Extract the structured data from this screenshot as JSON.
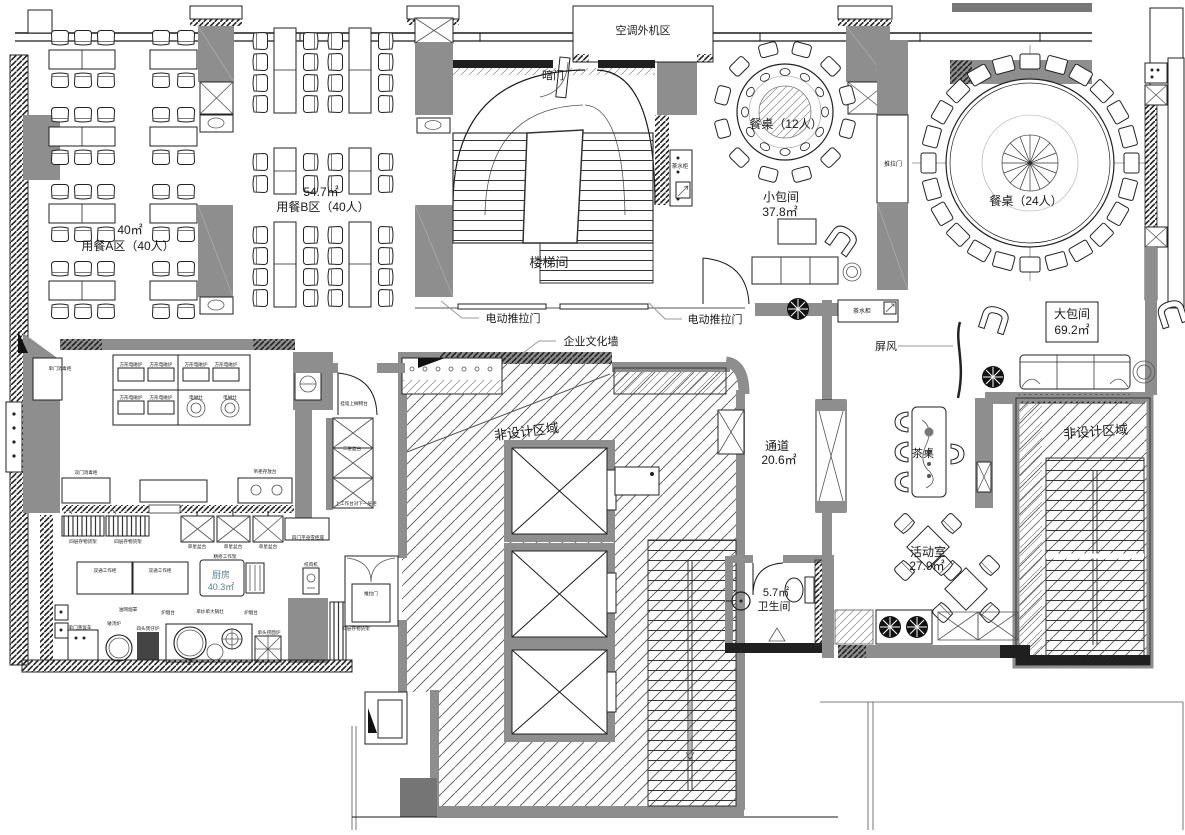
{
  "colors": {
    "wall_gray": "#8e8e8e",
    "dark_band": "#1f1f1f",
    "line": "#1a1a1a",
    "hatch": "#555555",
    "kitchen_text": "#5b7f91"
  },
  "rooms": {
    "ac_unit_area": {
      "name": "空调外机区"
    },
    "stairwell": {
      "name": "楼梯间"
    },
    "dining_a": {
      "name": "用餐A区（40人）",
      "area": "40㎡"
    },
    "dining_b": {
      "name": "用餐B区（40人）",
      "area": "54.7㎡"
    },
    "table_12": {
      "name": "餐桌（12人）"
    },
    "table_24": {
      "name": "餐桌（24人）"
    },
    "small_room": {
      "name": "小包间",
      "area": "37.8㎡"
    },
    "big_room": {
      "name": "大包间",
      "area": "69.2㎡"
    },
    "corridor": {
      "name": "通道",
      "area": "20.6㎡"
    },
    "activity_room": {
      "name": "活动室",
      "area": "27.9㎡"
    },
    "toilet": {
      "name": "卫生间",
      "area": "5.7㎡"
    },
    "kitchen": {
      "name": "厨房",
      "area": "40.3㎡"
    },
    "non_design_center": {
      "name": "非设计区域"
    },
    "non_design_right": {
      "name": "非设计区域"
    }
  },
  "annotations": {
    "hidden_door": "暗门",
    "electric_sliding_door": "电动推拉门",
    "sliding_door": "推拉门",
    "culture_wall": "企业文化墙",
    "screen": "屏风",
    "tea_table": "茶桌",
    "tea_cabinet": "茶水柜"
  },
  "kitchen_equipment": {
    "single_door_sterilizer": "单门消毒柜",
    "square_induction": "方形电磁炉",
    "induction_stove": "电磁灶",
    "double_door_sterilizer": "双门消毒柜",
    "hanging_cabinet": "吊柜存放台",
    "wall_shelf": "挂墙上搁物台",
    "three_star_sink": "三星盆台",
    "worktable_under_cabinet": "上工作台对下一层柜",
    "four_door_fridge": "四门平身雪柜座",
    "meat_grinder": "绞肉机",
    "storage_rack": "四层存物货架",
    "single_star_sink": "单星盆台",
    "double_work_cabinet": "双通工作柜",
    "trim_work_rack": "精修工作架",
    "grease_hood": "油网烟罩",
    "low_soup_stove": "矮汤炉",
    "four_head_stove": "四头煲仔炉",
    "single_wok_stove": "单炒单大锅灶",
    "stove_hood_table": "炉烟台",
    "noodle_stove": "单头捞面炉",
    "rice_steamer": "单门蒸饭车"
  }
}
